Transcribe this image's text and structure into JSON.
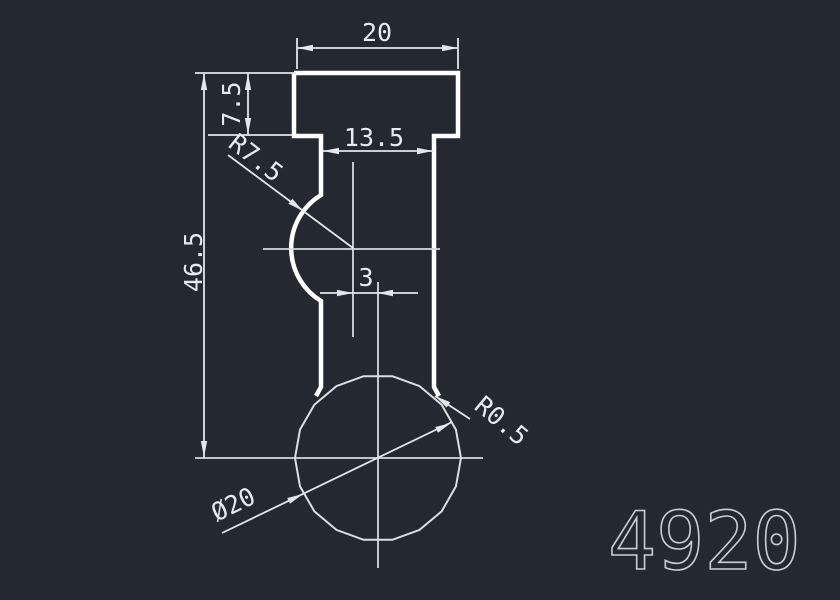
{
  "theme": {
    "bg": "#232831",
    "object_line": "#ffffff",
    "sphere_line": "#dcdfe3",
    "center_line": "#d7dade",
    "dim_line": "#e3e6ea",
    "dim_text": "#e8eaee",
    "part_number_color": "#c9ced6"
  },
  "drawing": {
    "labels": {
      "head_width": "20",
      "head_height": "7.5",
      "neck_width": "13.5",
      "groove_radius": "R7.5",
      "overall_height": "46.5",
      "center_offset": "3",
      "fillet_radius": "R0.5",
      "sphere_diameter": "Ø20"
    },
    "part_number": "4920"
  }
}
